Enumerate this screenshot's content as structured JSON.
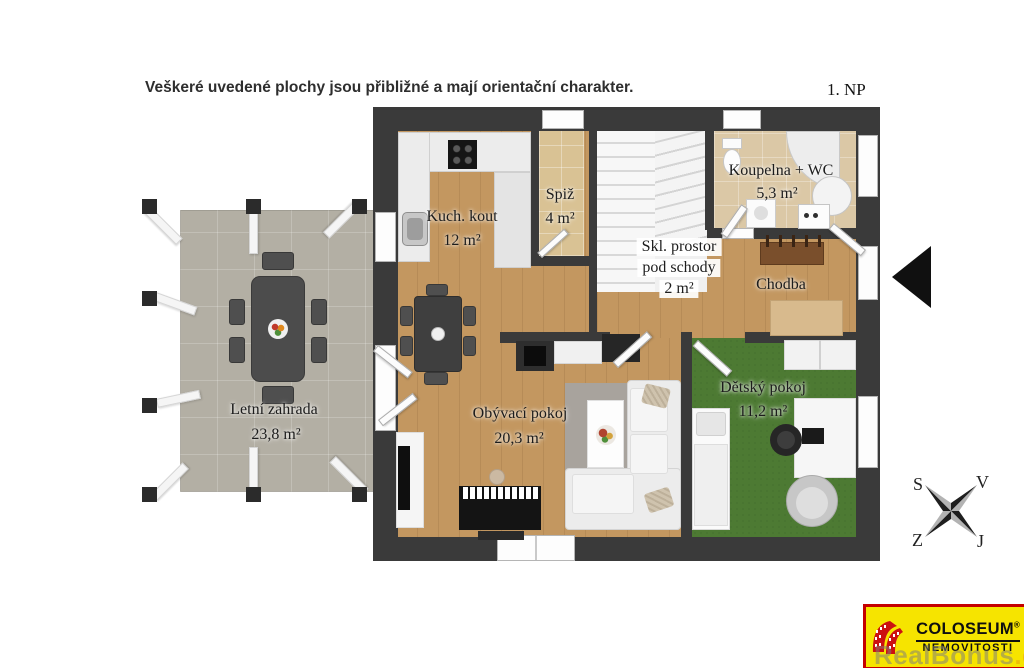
{
  "disclaimer": "Veškeré uvedené plochy jsou přibližné a mají orientační charakter.",
  "floor_label": "1. NP",
  "rooms": {
    "kitchen": {
      "name": "Kuch. kout",
      "area": "12 m²"
    },
    "pantry": {
      "name": "Spiž",
      "area": "4 m²"
    },
    "bathroom": {
      "name": "Koupelna + WC",
      "area": "5,3 m²"
    },
    "storage": {
      "line1": "Skl. prostor",
      "line2": "pod schody",
      "area": "2 m²"
    },
    "hallway": {
      "name": "Chodba"
    },
    "garden": {
      "name": "Letní zahrada",
      "area": "23,8 m²"
    },
    "living": {
      "name": "Obývací pokoj",
      "area": "20,3 m²"
    },
    "kids": {
      "name": "Dětský pokoj",
      "area": "11,2 m²"
    }
  },
  "compass": {
    "top_left": "S",
    "top_right": "V",
    "bottom_left": "Z",
    "bottom_right": "J"
  },
  "logo": {
    "brand": "COLOSEUM",
    "registered": "®",
    "subtitle": "NEMOVITOSTI"
  },
  "watermark": {
    "text": "RealBonus",
    "suffix": ".cz"
  },
  "colors": {
    "wall": "#3a3a3a",
    "wood_floor": "#c39760",
    "pantry_floor": "#d9c294",
    "bathroom_tile": "#dbc8a6",
    "kids_floor": "#4d7a33",
    "terrace": "#b3afa4",
    "stairs": "#ededed",
    "logo_yellow": "#f6e400",
    "logo_red": "#cc1111",
    "entrance_arrow": "#101010"
  }
}
